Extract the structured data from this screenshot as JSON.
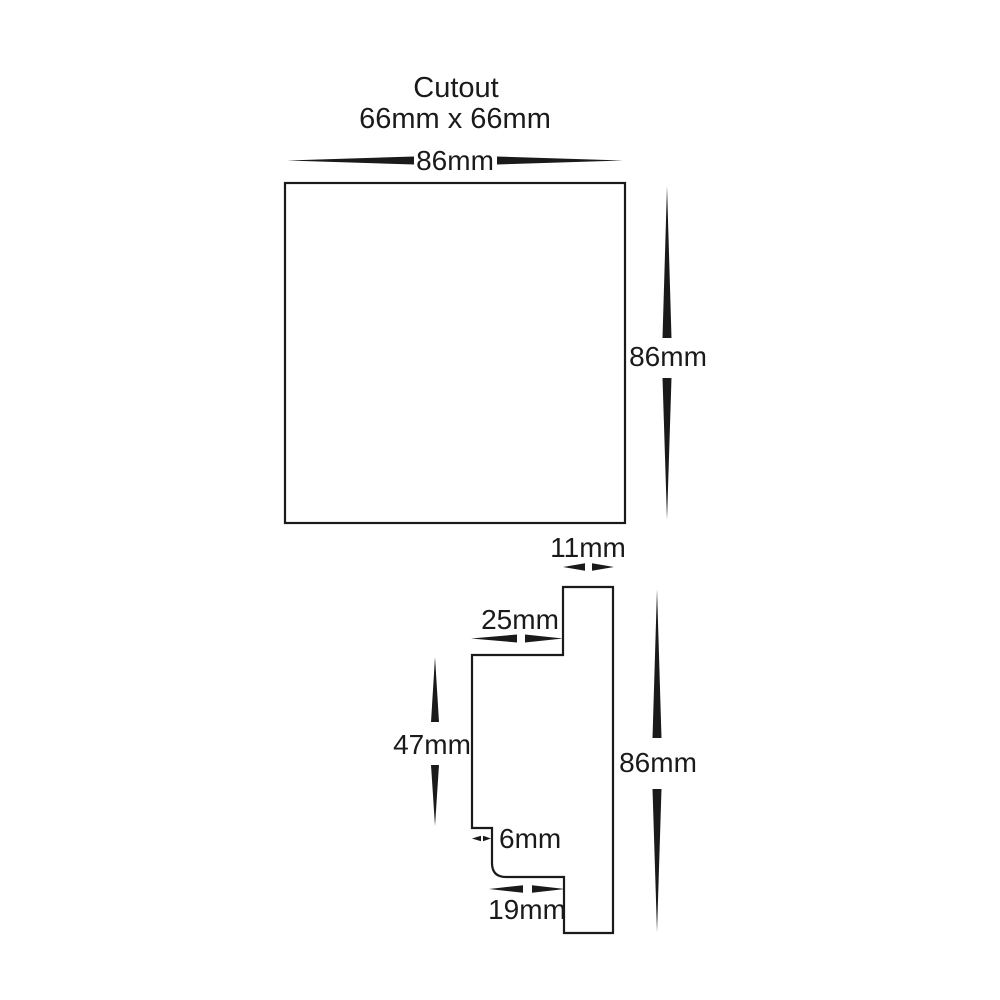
{
  "title": {
    "line1": "Cutout",
    "line2": "66mm x 66mm"
  },
  "top_view": {
    "name": "front face top view",
    "width_label": "86mm",
    "height_label": "86mm"
  },
  "side_view": {
    "name": "side profile view",
    "top_tab_width_label": "11mm",
    "upper_shelf_width_label": "25mm",
    "body_height_label": "47mm",
    "overall_height_label": "86mm",
    "step_depth_label": "6mm",
    "lower_shelf_width_label": "19mm"
  },
  "colors": {
    "line": "#1a1a1a",
    "text": "#1a1a1a",
    "background": "#ffffff"
  }
}
